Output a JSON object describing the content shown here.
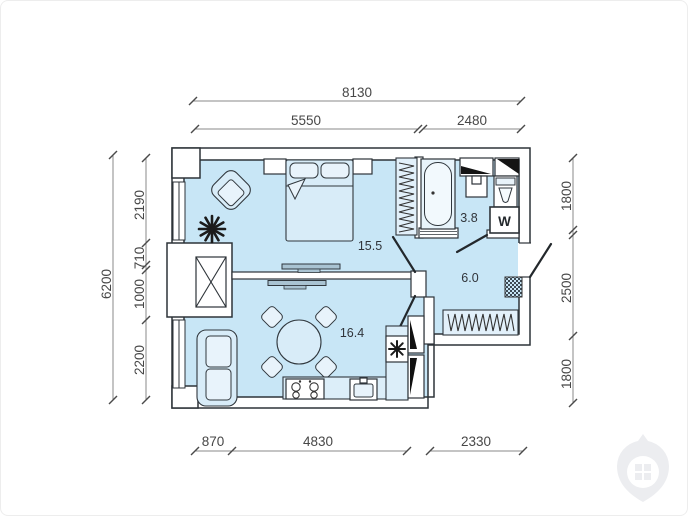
{
  "plan": {
    "rooms": [
      {
        "id": "bedroom",
        "area_label": "15.5"
      },
      {
        "id": "bathroom",
        "area_label": "3.8"
      },
      {
        "id": "hallway",
        "area_label": "6.0"
      },
      {
        "id": "kitchen_living",
        "area_label": "16.4"
      }
    ],
    "appliance_labels": {
      "washing_machine": "W"
    },
    "dimensions_mm": {
      "top_overall": "8130",
      "top_segments": [
        "5550",
        "2480"
      ],
      "bottom_segments": [
        "870",
        "4830",
        "2330"
      ],
      "left_overall": "6200",
      "left_segments": [
        "2190",
        "710",
        "1000",
        "2200"
      ],
      "right_segments": [
        "1800",
        "2500",
        "1800"
      ]
    },
    "colors": {
      "floor_fill": "#c8e6f6",
      "wall_fill": "#ffffff",
      "outline": "#2d3338",
      "dimension_text": "#474747"
    }
  }
}
